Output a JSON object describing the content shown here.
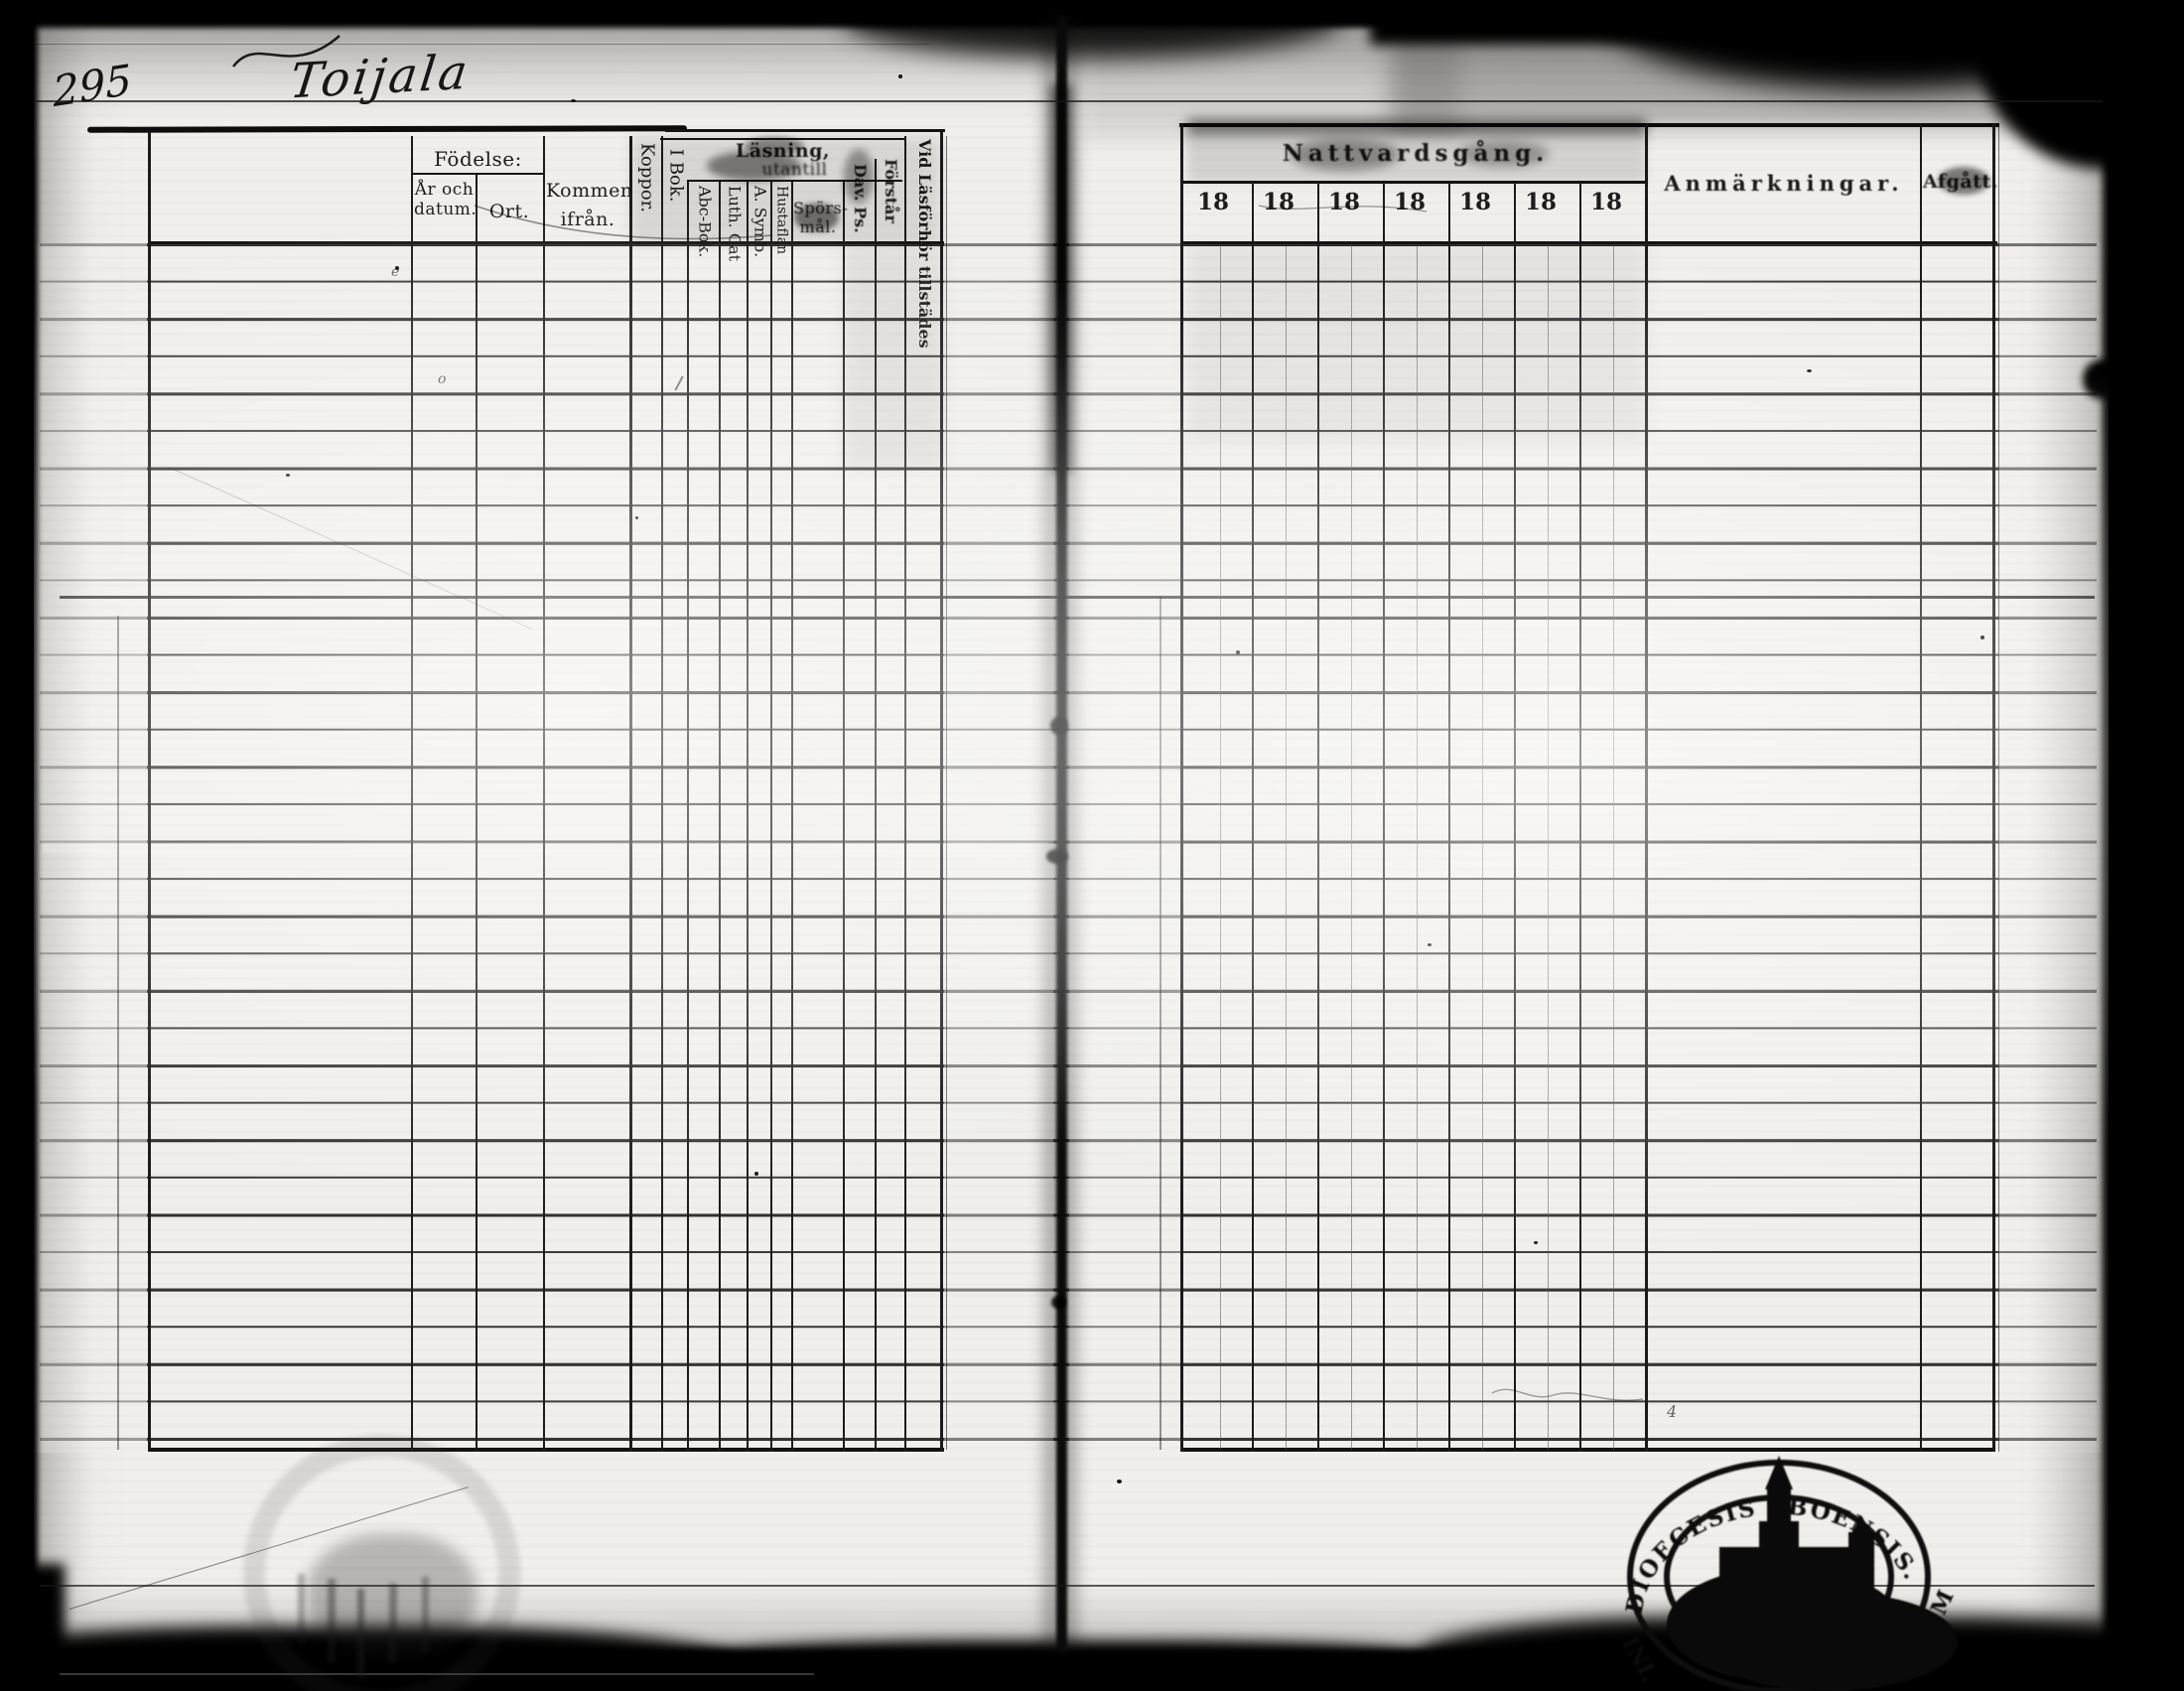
{
  "page": {
    "number": "295",
    "title": "Toijala"
  },
  "left_table": {
    "fodelse_group": "Födelse:",
    "col_ar": "År och datum.",
    "col_ort": "Ort.",
    "col_kommen": "Kommen ifrån.",
    "col_koppor": "Koppor.",
    "col_ibok": "I Bok.",
    "lasning_group": "Läsning,",
    "lasning_sub": "utantill",
    "col_abc": "Abc-Bok.",
    "col_luth": "Luth. Cat",
    "col_symb": "A. Symb.",
    "col_hustaflan": "Hustaflan",
    "col_spors": "Spörs- mål.",
    "col_dav": "Dav. Ps.",
    "col_forstar": "Förstår",
    "col_vidlas": "Vid Läsförhör tillstädes"
  },
  "right_table": {
    "natt_group": "Nattvardsgång.",
    "years": [
      "18",
      "18",
      "18",
      "18",
      "18",
      "18",
      "18"
    ],
    "col_anm": "Anmärkningar.",
    "col_afgatt": "Afgått."
  },
  "stamp": {
    "arc_text": "DIOECESIS ABOENSIS.",
    "left_text": "INI.",
    "right_text": "M"
  },
  "marks": {
    "mark1": "e",
    "mark2": "o",
    "mark3": "4"
  }
}
